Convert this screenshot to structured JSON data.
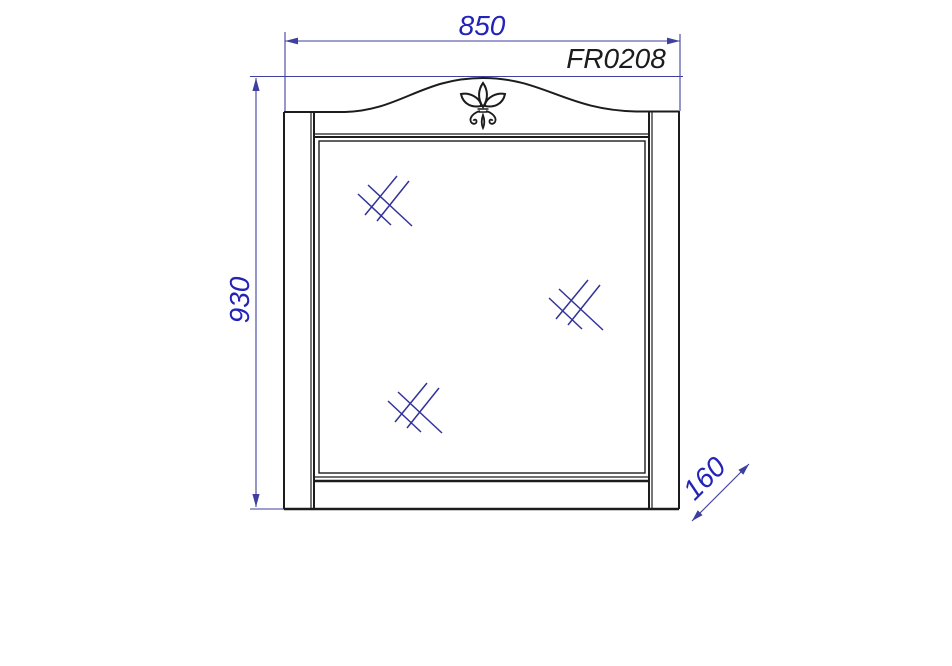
{
  "drawing": {
    "subject": "wall-mirror-front-elevation",
    "model": "FR0208",
    "dimensions": {
      "width": "850",
      "height": "930",
      "depth": "160"
    },
    "ornament": "fleur-de-lis",
    "glass_mark_count": 3
  },
  "colors": {
    "background": "#ffffff",
    "ink": "#1c1c1c",
    "dimension_line": "#3f3f9f",
    "dimension_text": "#2323b8",
    "hatch": "#32329c"
  }
}
